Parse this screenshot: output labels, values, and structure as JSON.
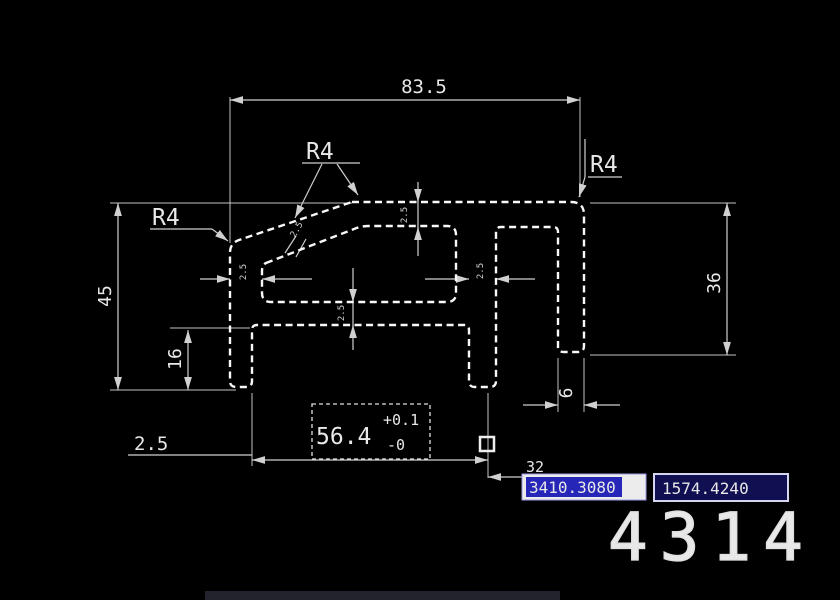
{
  "window": {
    "background": "#000000"
  },
  "drawing": {
    "dimensions": {
      "top_width": "83.5",
      "left_height": "45",
      "left_leg_height": "16",
      "right_height": "36",
      "bottom_width": "56.4",
      "bottom_width_tol_plus": "+0.1",
      "bottom_width_tol_minus": "-0",
      "bottom_left_offset": "2.5",
      "right_leg_width": "6",
      "hidden_width": "32",
      "radius_top": "R4",
      "radius_left": "R4",
      "radius_right": "R4",
      "wall_thickness_left": "2.5",
      "wall_thickness_middle": "2.5",
      "wall_thickness_top": "2.5",
      "wall_thickness_bottom": "2.5",
      "wall_thickness_slope": "2.5"
    },
    "icons": {
      "grip_marker": "square-grip",
      "arrowhead": "dimension-arrow"
    },
    "colors": {
      "dimension_line": "#d0d0d0",
      "profile_line": "#f8f8f8",
      "coord_highlight_bg": "#2626b8",
      "coord_input_bg": "#0f0f52",
      "text": "#e8e8e8"
    }
  },
  "status": {
    "coord_x": "3410.3080",
    "coord_y": "1574.4240",
    "part_number": "4314"
  }
}
